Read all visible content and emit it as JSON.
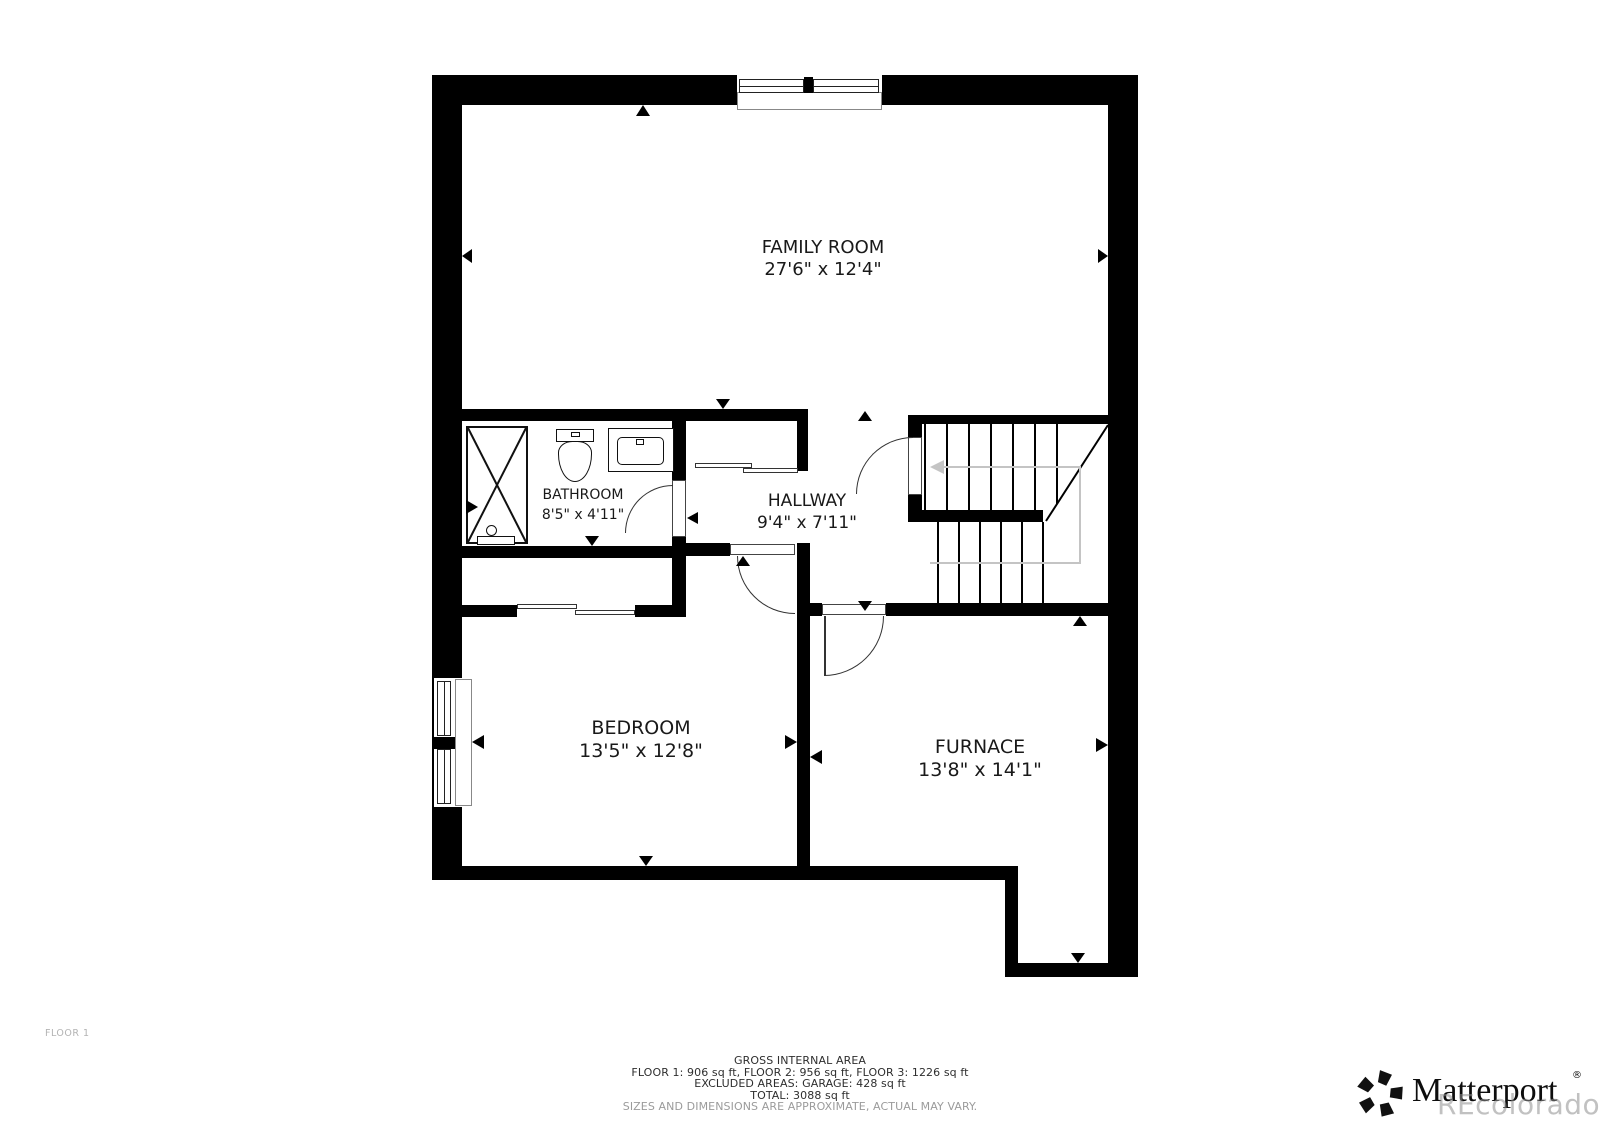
{
  "floor_plan": {
    "floor_label": "FLOOR 1",
    "rooms": [
      {
        "name": "FAMILY ROOM",
        "dimensions": "27'6\" x 12'4\""
      },
      {
        "name": "BATHROOM",
        "dimensions": "8'5\" x 4'11\""
      },
      {
        "name": "HALLWAY",
        "dimensions": "9'4\" x 7'11\""
      },
      {
        "name": "BEDROOM",
        "dimensions": "13'5\" x 12'8\""
      },
      {
        "name": "FURNACE",
        "dimensions": "13'8\" x 14'1\""
      }
    ],
    "footer": {
      "title": "GROSS INTERNAL AREA",
      "areas_line": "FLOOR 1: 906 sq ft, FLOOR 2: 956 sq ft, FLOOR 3: 1226 sq ft",
      "excluded_line": "EXCLUDED AREAS: GARAGE: 428 sq ft",
      "total_line": "TOTAL: 3088 sq ft",
      "disclaimer": "SIZES AND DIMENSIONS ARE APPROXIMATE, ACTUAL MAY VARY."
    },
    "branding": {
      "logo_text": "Matterport",
      "registered_mark": "®",
      "watermark": "REcolorado"
    },
    "colors": {
      "wall": "#000000",
      "background": "#ffffff",
      "label_text": "#191919",
      "muted_text": "#9b9b9b",
      "stair_guide": "#c4c4c4"
    }
  }
}
